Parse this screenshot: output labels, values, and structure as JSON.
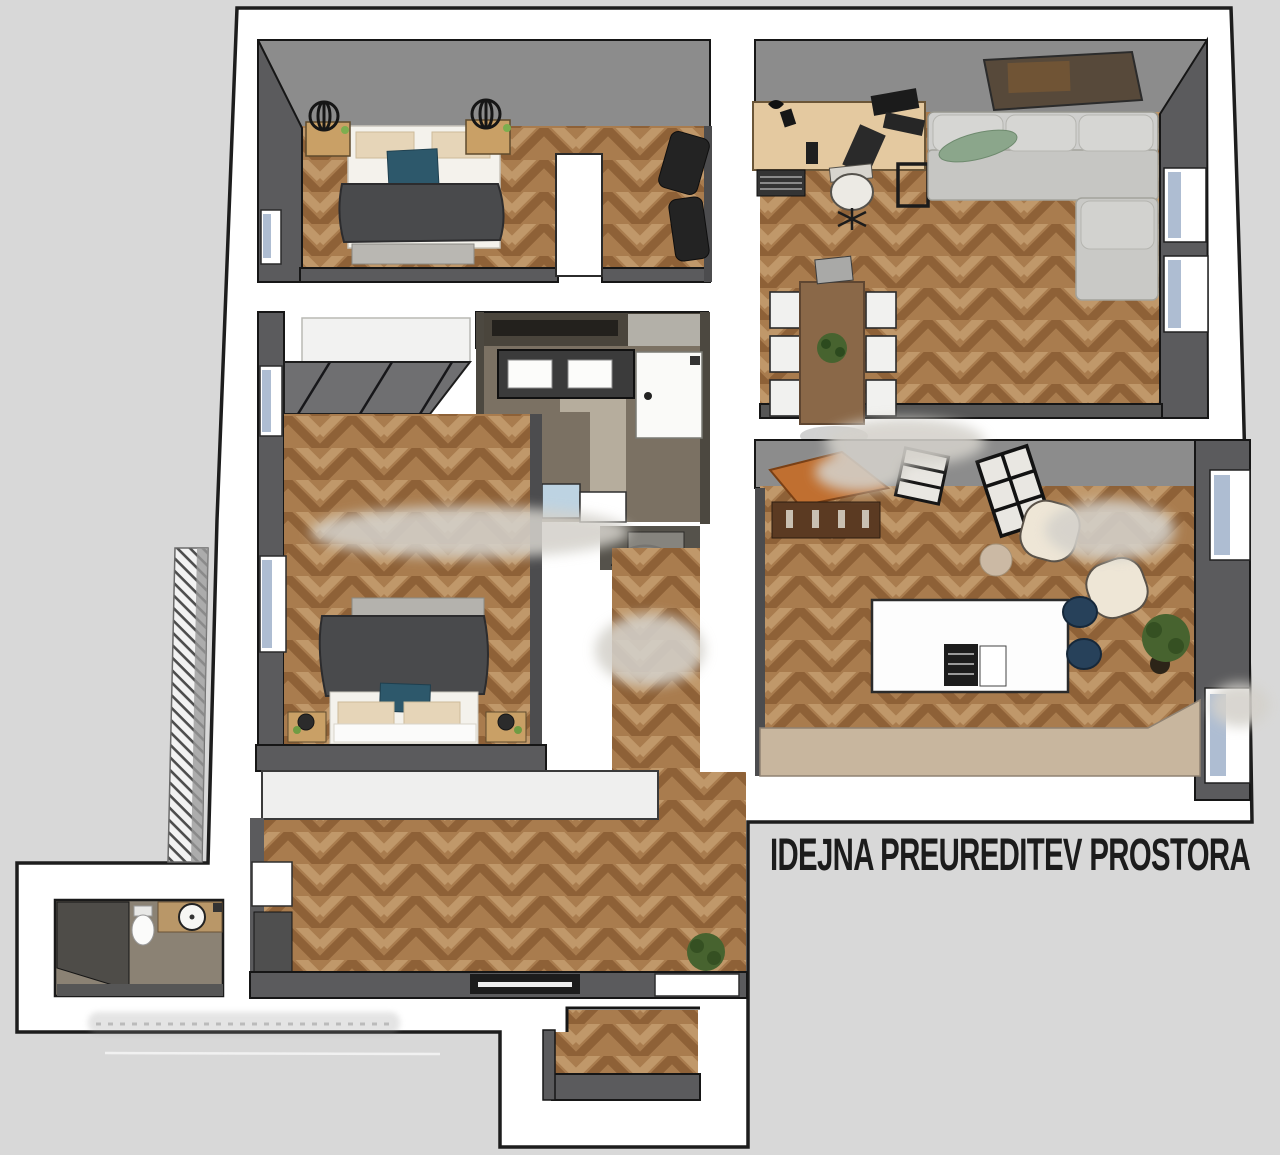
{
  "title": {
    "text": "IDEJNA PREUREDITEV PROSTORA"
  },
  "colors": {
    "background": "#d8d8d8",
    "page": "#ffffff",
    "title": "#1c1c1c",
    "wall_top": "#8c8c8c",
    "wall_side": "#5b5b5d",
    "wall_thin": "#4c4c4e",
    "wall_bath": "#4a453c",
    "floor_tile": "#7b7163",
    "floor_tile_wc": "#8b8274",
    "walkway": "#b6ad9d",
    "duvet": "#494a4c",
    "teal_pillow": "#2d586b",
    "linen": "#f4f2ec",
    "pillow_tan": "#e6d5b8",
    "nightstand": "#c9a066",
    "sofa_back": "#cfcfcd",
    "sofa_seat": "#c6c6c3",
    "sofa_cushion": "#d6d6d3",
    "green_pillow": "#8ba68b",
    "desk_wood": "#e4c9a0",
    "table_wood": "#8a6848",
    "chair_white": "#f1f1ef",
    "cabinet_orange": "#c06f30",
    "cabinet_base": "#5b3a22",
    "island_white": "#fdfdfd",
    "stove_black": "#1d1d1d",
    "stool_navy": "#27415a",
    "counter_beige": "#c8b69e",
    "armchair_cream": "#eee6d6",
    "plant_green": "#47632f",
    "shower_blue": "#bdd3e2",
    "window_glass": "#aebdd2",
    "closet_white": "#efefee",
    "doormat_black": "#1c1c1c",
    "vanity_dark": "#3b3b3b",
    "appliance_white": "#fafaf8",
    "vanity_wood": "#b99768",
    "artwork_brown": "#57493a",
    "smudge": "#d4d1cb"
  }
}
